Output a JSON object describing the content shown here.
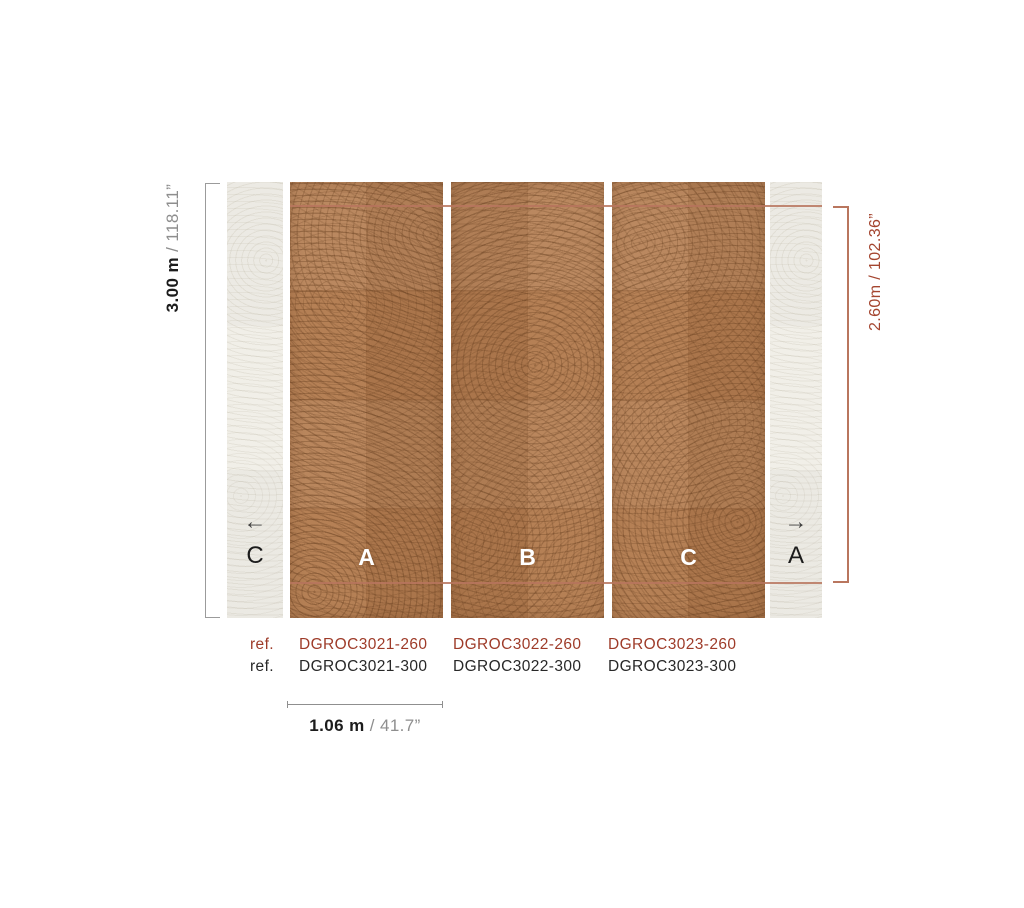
{
  "diagram": {
    "dims": {
      "height_full_metric": "3.00 m",
      "height_full_imperial": " / 118.11”",
      "height_panel": "2.60m / 102.36”",
      "width_metric": "1.06 m",
      "width_imperial": " / 41.7”"
    },
    "panels": [
      {
        "label": "A"
      },
      {
        "label": "B"
      },
      {
        "label": "C"
      }
    ],
    "left_repeat": {
      "arrow": "←",
      "label": "C"
    },
    "right_repeat": {
      "arrow": "→",
      "label": "A"
    },
    "refs": {
      "rows": [
        {
          "label": "ref.",
          "codes": [
            "DGROC3021-260",
            "DGROC3022-260",
            "DGROC3023-260"
          ]
        },
        {
          "label": "ref.",
          "codes": [
            "DGROC3021-300",
            "DGROC3022-300",
            "DGROC3023-300"
          ]
        }
      ]
    },
    "colors": {
      "accent_text": "#9e3b29",
      "accent_line": "#b9765e",
      "bracket_gray": "#9b9b9b",
      "panel_brown": "#b17a4e",
      "panel_cream": "#f1efe8"
    }
  }
}
